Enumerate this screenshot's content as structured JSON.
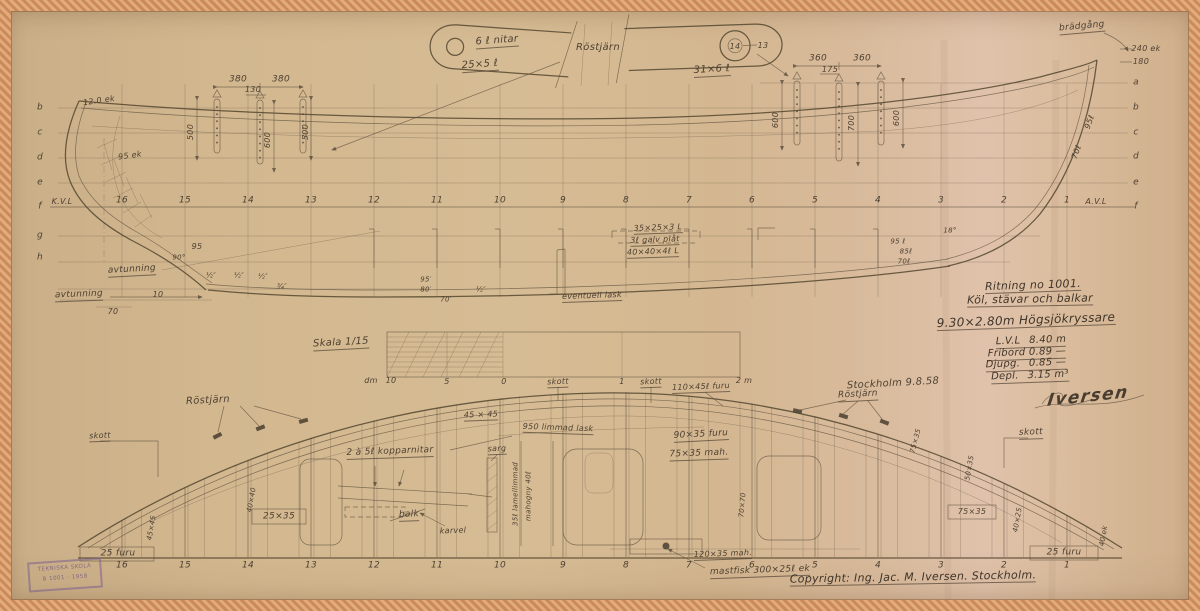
{
  "colors": {
    "paper": "#d5bb93",
    "tape": "#d89a6a",
    "pencil": "#5b4d3c",
    "ink": "#3f3429",
    "stamp_purple": "#7b5f8f"
  },
  "stamp": {
    "line1": "TEKNISKA SKOLA",
    "line2": "B 1001 · 1958"
  },
  "frames": {
    "profile_y": 201,
    "plan_y": 566,
    "stations": [
      {
        "label": "16",
        "x": 122
      },
      {
        "label": "15",
        "x": 185
      },
      {
        "label": "14",
        "x": 248
      },
      {
        "label": "13",
        "x": 311
      },
      {
        "label": "12",
        "x": 374
      },
      {
        "label": "11",
        "x": 437
      },
      {
        "label": "10",
        "x": 500
      },
      {
        "label": "9",
        "x": 563
      },
      {
        "label": "8",
        "x": 626
      },
      {
        "label": "7",
        "x": 689
      },
      {
        "label": "6",
        "x": 752
      },
      {
        "label": "5",
        "x": 815
      },
      {
        "label": "4",
        "x": 878
      },
      {
        "label": "3",
        "x": 941
      },
      {
        "label": "2",
        "x": 1004
      },
      {
        "label": "1",
        "x": 1067
      }
    ]
  },
  "waterline_letters": {
    "left_x": 40,
    "right_x": 1136,
    "left": [
      {
        "t": "b",
        "y": 108
      },
      {
        "t": "c",
        "y": 133
      },
      {
        "t": "d",
        "y": 158
      },
      {
        "t": "e",
        "y": 183
      },
      {
        "t": "f",
        "y": 207
      },
      {
        "t": "g",
        "y": 236
      },
      {
        "t": "h",
        "y": 258
      }
    ],
    "right": [
      {
        "t": "a",
        "y": 83
      },
      {
        "t": "b",
        "y": 108
      },
      {
        "t": "c",
        "y": 133
      },
      {
        "t": "d",
        "y": 157
      },
      {
        "t": "e",
        "y": 183
      },
      {
        "t": "f",
        "y": 207
      }
    ]
  },
  "annotations": [
    {
      "n": "detail-rivets-label",
      "t": "6 ℓ nitar",
      "x": 497,
      "y": 42,
      "s": 10,
      "r": -4,
      "u": true
    },
    {
      "n": "detail-strap-dim",
      "t": "25×5 ℓ",
      "x": 480,
      "y": 66,
      "s": 10,
      "r": -4,
      "u": true
    },
    {
      "n": "rostjarn-top-label",
      "t": "Röstjärn",
      "x": 598,
      "y": 48,
      "s": 10,
      "r": 0
    },
    {
      "n": "detail-strap2-dim",
      "t": "31×6 ℓ",
      "x": 712,
      "y": 71,
      "s": 10,
      "r": -3,
      "u": true
    },
    {
      "n": "detail-hole-number",
      "t": "14",
      "x": 735,
      "y": 47,
      "s": 8
    },
    {
      "n": "detail-plate-number",
      "t": "13",
      "x": 763,
      "y": 46,
      "s": 8
    },
    {
      "n": "dim-380-a",
      "t": "380",
      "x": 238,
      "y": 80,
      "s": 9
    },
    {
      "n": "dim-130",
      "t": "130",
      "x": 253,
      "y": 90,
      "s": 8
    },
    {
      "n": "dim-380-b",
      "t": "380",
      "x": 281,
      "y": 80,
      "s": 9
    },
    {
      "n": "dim-500-a",
      "t": "500",
      "x": 191,
      "y": 132,
      "s": 8,
      "r": -90
    },
    {
      "n": "dim-600-a",
      "t": "600",
      "x": 268,
      "y": 140,
      "s": 8,
      "r": -90
    },
    {
      "n": "dim-500-b",
      "t": "500",
      "x": 306,
      "y": 132,
      "s": 8,
      "r": -90
    },
    {
      "n": "dim-360-a",
      "t": "360",
      "x": 818,
      "y": 59,
      "s": 9
    },
    {
      "n": "dim-175",
      "t": "175",
      "x": 830,
      "y": 70,
      "s": 8
    },
    {
      "n": "dim-360-b",
      "t": "360",
      "x": 862,
      "y": 59,
      "s": 9
    },
    {
      "n": "dim-600-b",
      "t": "600",
      "x": 776,
      "y": 120,
      "s": 8,
      "r": -90
    },
    {
      "n": "dim-700",
      "t": "700",
      "x": 852,
      "y": 123,
      "s": 8,
      "r": -90
    },
    {
      "n": "dim-600-c",
      "t": "600",
      "x": 897,
      "y": 118,
      "s": 8,
      "r": -90
    },
    {
      "n": "stern-ek-dim",
      "t": "12.0 ek",
      "x": 99,
      "y": 101,
      "s": 8,
      "r": -8
    },
    {
      "n": "stern-ek-dim2",
      "t": "95 ek",
      "x": 130,
      "y": 156,
      "s": 8,
      "r": -8
    },
    {
      "n": "kvl-label",
      "t": "K.V.L",
      "x": 62,
      "y": 202,
      "s": 8
    },
    {
      "n": "avl-label",
      "t": "A.V.L",
      "x": 1096,
      "y": 202,
      "s": 8
    },
    {
      "n": "bradgang-label",
      "t": "brädgång",
      "x": 1082,
      "y": 28,
      "s": 9,
      "r": -5,
      "u": true
    },
    {
      "n": "stem-ek-dim",
      "t": "240 ek",
      "x": 1146,
      "y": 49,
      "s": 8
    },
    {
      "n": "stem-dim-180",
      "t": "180",
      "x": 1141,
      "y": 62,
      "s": 8
    },
    {
      "n": "stem-95",
      "t": "95ℓ",
      "x": 1090,
      "y": 122,
      "s": 8,
      "r": -70
    },
    {
      "n": "stem-70",
      "t": "70ℓ",
      "x": 1077,
      "y": 152,
      "s": 8,
      "r": -70
    },
    {
      "n": "avtunning-upper",
      "t": "avtunning",
      "x": 132,
      "y": 271,
      "s": 9,
      "r": -3,
      "u": true
    },
    {
      "n": "avtunning-lower",
      "t": "avtunning",
      "x": 79,
      "y": 296,
      "s": 9,
      "r": -2,
      "u": true
    },
    {
      "n": "dim-70-stern",
      "t": "70",
      "x": 113,
      "y": 312,
      "s": 8
    },
    {
      "n": "dim-10",
      "t": "10",
      "x": 158,
      "y": 295,
      "s": 8
    },
    {
      "n": "dim-95-stern",
      "t": "95",
      "x": 197,
      "y": 247,
      "s": 8
    },
    {
      "n": "angle-90",
      "t": "90°",
      "x": 179,
      "y": 258,
      "s": 7
    },
    {
      "n": "taper-half-a",
      "t": "½″",
      "x": 211,
      "y": 276,
      "s": 7
    },
    {
      "n": "taper-half-b",
      "t": "½″",
      "x": 239,
      "y": 276,
      "s": 7
    },
    {
      "n": "taper-half-c",
      "t": "½″",
      "x": 263,
      "y": 277,
      "s": 7
    },
    {
      "n": "taper-half-d",
      "t": "¾″",
      "x": 282,
      "y": 287,
      "s": 7
    },
    {
      "n": "bracket-dim-1",
      "t": "35×25×3 L",
      "x": 658,
      "y": 229,
      "s": 8,
      "r": -2,
      "u": true
    },
    {
      "n": "bracket-dim-2",
      "t": "3ℓ galv plåt",
      "x": 655,
      "y": 241,
      "s": 8,
      "r": -2,
      "u": true
    },
    {
      "n": "bracket-dim-3",
      "t": "40×40×4ℓ L",
      "x": 653,
      "y": 253,
      "s": 8,
      "r": -2,
      "u": true
    },
    {
      "n": "lask-label",
      "t": "eventuell lask",
      "x": 592,
      "y": 297,
      "s": 8,
      "r": -2,
      "u": true
    },
    {
      "n": "keel-dim-95",
      "t": "95′",
      "x": 426,
      "y": 280,
      "s": 7
    },
    {
      "n": "keel-dim-80",
      "t": "80′",
      "x": 426,
      "y": 290,
      "s": 7
    },
    {
      "n": "keel-dim-70",
      "t": "70′",
      "x": 446,
      "y": 300,
      "s": 7
    },
    {
      "n": "keel-half",
      "t": "½″",
      "x": 481,
      "y": 290,
      "s": 7
    },
    {
      "n": "bow-dim-95",
      "t": "95 ℓ",
      "x": 898,
      "y": 242,
      "s": 7
    },
    {
      "n": "bow-dim-85",
      "t": "85ℓ",
      "x": 906,
      "y": 252,
      "s": 7
    },
    {
      "n": "bow-dim-70",
      "t": "70ℓ",
      "x": 904,
      "y": 262,
      "s": 7
    },
    {
      "n": "bow-angle-18",
      "t": "18°",
      "x": 950,
      "y": 231,
      "s": 7
    },
    {
      "n": "skala-label",
      "t": "Skala 1/15",
      "x": 341,
      "y": 344,
      "s": 10,
      "r": -3,
      "u": true
    },
    {
      "n": "scale-dm",
      "t": "dm",
      "x": 371,
      "y": 381,
      "s": 8
    },
    {
      "n": "scale-10",
      "t": "10",
      "x": 391,
      "y": 381,
      "s": 8
    },
    {
      "n": "scale-5",
      "t": "5",
      "x": 447,
      "y": 382,
      "s": 8
    },
    {
      "n": "scale-0",
      "t": "0",
      "x": 504,
      "y": 382,
      "s": 8
    },
    {
      "n": "scale-1",
      "t": "1",
      "x": 622,
      "y": 382,
      "s": 8
    },
    {
      "n": "scale-2m",
      "t": "2 m",
      "x": 744,
      "y": 381,
      "s": 8
    },
    {
      "n": "title-line-1",
      "t": "Ritning no 1001.",
      "x": 1033,
      "y": 286,
      "s": 11,
      "r": -2,
      "u": true,
      "cls": "ink"
    },
    {
      "n": "title-line-2",
      "t": "Köl, stävar och balkar",
      "x": 1030,
      "y": 300,
      "s": 11,
      "r": -1,
      "u": true,
      "cls": "ink"
    },
    {
      "n": "title-type",
      "t": "9.30×2.80m Högsjökryssare",
      "x": 1026,
      "y": 321,
      "s": 12,
      "r": -2,
      "u": true,
      "cls": "ink"
    },
    {
      "n": "spec-lvl",
      "t": "L.V.L  8.40 m",
      "x": 1031,
      "y": 342,
      "s": 10,
      "r": -2,
      "u": true,
      "cls": "ink"
    },
    {
      "n": "spec-fribord",
      "t": "Fribord 0.89 —",
      "x": 1027,
      "y": 354,
      "s": 10,
      "r": -2,
      "u": true,
      "cls": "ink"
    },
    {
      "n": "spec-djupg",
      "t": "Djupg.  0.85 —",
      "x": 1026,
      "y": 365,
      "s": 10,
      "r": -2,
      "u": true,
      "cls": "ink"
    },
    {
      "n": "spec-depl",
      "t": "Depl.  3.15 m³",
      "x": 1030,
      "y": 377,
      "s": 10,
      "r": -2,
      "u": true,
      "cls": "ink"
    },
    {
      "n": "place-date",
      "t": "Stockholm 9.8.58",
      "x": 893,
      "y": 384,
      "s": 10,
      "r": -3
    },
    {
      "n": "signature",
      "t": "Iversen",
      "x": 1088,
      "y": 397,
      "s": 17,
      "r": -6,
      "cls": "script"
    },
    {
      "n": "rostjarn-plan-left",
      "t": "Röstjärn",
      "x": 208,
      "y": 401,
      "s": 10,
      "r": -3
    },
    {
      "n": "rostjarn-plan-right",
      "t": "Röstjärn",
      "x": 858,
      "y": 396,
      "s": 9,
      "r": -3,
      "u": true
    },
    {
      "n": "skott-left",
      "t": "skott",
      "x": 100,
      "y": 437,
      "s": 8,
      "r": -2,
      "u": true
    },
    {
      "n": "skott-mid-1",
      "t": "skott",
      "x": 558,
      "y": 383,
      "s": 8,
      "r": -2,
      "u": true
    },
    {
      "n": "skott-mid-2",
      "t": "skott",
      "x": 651,
      "y": 383,
      "s": 8,
      "r": -2,
      "u": true
    },
    {
      "n": "skott-right",
      "t": "skott",
      "x": 1031,
      "y": 434,
      "s": 9,
      "r": -2,
      "u": true
    },
    {
      "n": "beam-dim-110",
      "t": "110×45ℓ furu",
      "x": 701,
      "y": 388,
      "s": 8,
      "r": -2,
      "u": true
    },
    {
      "n": "dim-45x45",
      "t": "45 × 45",
      "x": 481,
      "y": 416,
      "s": 8,
      "r": -2,
      "u": true
    },
    {
      "n": "limmad-lask",
      "t": "950 limmad lask",
      "x": 558,
      "y": 429,
      "s": 8,
      "r": 2,
      "u": true
    },
    {
      "n": "kopparnitar",
      "t": "2 à 5ℓ kopparnitar",
      "x": 390,
      "y": 453,
      "s": 9,
      "r": -2,
      "u": true
    },
    {
      "n": "sarg-label",
      "t": "sarg",
      "x": 497,
      "y": 450,
      "s": 8,
      "r": -2,
      "u": true
    },
    {
      "n": "balk-label",
      "t": "balk",
      "x": 409,
      "y": 516,
      "s": 9,
      "r": -2,
      "u": true
    },
    {
      "n": "karvel-label",
      "t": "karvel",
      "x": 453,
      "y": 531,
      "s": 8,
      "r": -2
    },
    {
      "n": "lamell-label",
      "t": "35ℓ lamellimmad",
      "x": 516,
      "y": 494,
      "s": 7,
      "r": -90
    },
    {
      "n": "mahogny-label",
      "t": "mahogny 40ℓ",
      "x": 529,
      "y": 496,
      "s": 7,
      "r": -90
    },
    {
      "n": "beam-dim-90",
      "t": "90×35 furu",
      "x": 701,
      "y": 436,
      "s": 9,
      "r": -3,
      "u": true
    },
    {
      "n": "beam-dim-75",
      "t": "75×35 mah.",
      "x": 699,
      "y": 455,
      "s": 9,
      "r": -2,
      "u": true
    },
    {
      "n": "rot-75x35",
      "t": "75×35",
      "x": 916,
      "y": 441,
      "s": 7,
      "r": -75
    },
    {
      "n": "box-25x35",
      "t": "25×35",
      "x": 279,
      "y": 517,
      "s": 9
    },
    {
      "n": "furu25-left",
      "t": "25 furu",
      "x": 118,
      "y": 554,
      "s": 9
    },
    {
      "n": "furu25-right",
      "t": "25 furu",
      "x": 1064,
      "y": 553,
      "s": 9
    },
    {
      "n": "box-75x35",
      "t": "75×35",
      "x": 972,
      "y": 512,
      "s": 8
    },
    {
      "n": "kingplank-dim",
      "t": "120×35 mah.",
      "x": 723,
      "y": 555,
      "s": 8,
      "r": -2,
      "u": true
    },
    {
      "n": "mastfisk-label",
      "t": "mastfisk 300×25ℓ ek",
      "x": 760,
      "y": 572,
      "s": 9,
      "r": -2,
      "u": true
    },
    {
      "n": "rot-40ek",
      "t": "40 ek",
      "x": 1104,
      "y": 536,
      "s": 7,
      "r": -80
    },
    {
      "n": "rot-50x35",
      "t": "50×35",
      "x": 970,
      "y": 468,
      "s": 7,
      "r": -80
    },
    {
      "n": "rot-40x25",
      "t": "40×25",
      "x": 1018,
      "y": 520,
      "s": 7,
      "r": -80
    },
    {
      "n": "rot-45x45",
      "t": "45×45",
      "x": 152,
      "y": 528,
      "s": 7,
      "r": -80
    },
    {
      "n": "rot-40x40",
      "t": "40×40",
      "x": 252,
      "y": 500,
      "s": 7,
      "r": -80
    },
    {
      "n": "rot-70x70",
      "t": "70×70",
      "x": 743,
      "y": 505,
      "s": 7,
      "r": -85
    },
    {
      "n": "copyright",
      "t": "Copyright: Ing. Jac. M. Iversen. Stockholm.",
      "x": 913,
      "y": 578,
      "s": 11,
      "r": -1,
      "u": true,
      "cls": "ink"
    }
  ]
}
